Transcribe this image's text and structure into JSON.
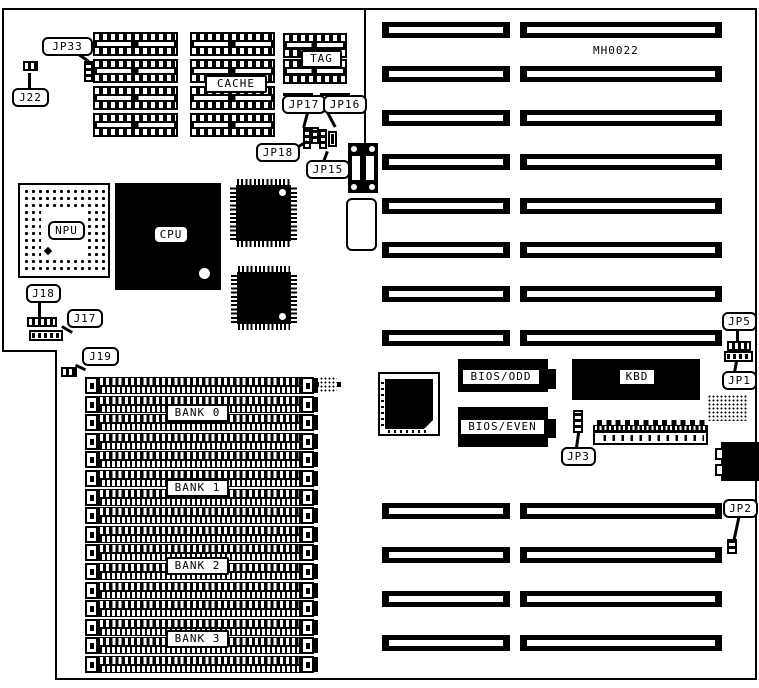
{
  "diagram": {
    "part_number": "MH0022",
    "callouts": {
      "jp33": "JP33",
      "j22": "J22",
      "jp17": "JP17",
      "jp16": "JP16",
      "jp18": "JP18",
      "jp15": "JP15",
      "j18": "J18",
      "j17": "J17",
      "j19": "J19",
      "jp5": "JP5",
      "jp1": "JP1",
      "jp2": "JP2",
      "jp3": "JP3"
    },
    "chips": {
      "cache": "CACHE",
      "tag": "TAG",
      "npu": "NPU",
      "cpu": "CPU",
      "bios_odd": "BIOS/ODD",
      "bios_even": "BIOS/EVEN",
      "kbd": "KBD"
    },
    "banks": [
      {
        "label": "BANK 0"
      },
      {
        "label": "BANK 1"
      },
      {
        "label": "BANK 2"
      },
      {
        "label": "BANK 3"
      }
    ],
    "colors": {
      "ink": "#000000",
      "paper": "#ffffff"
    }
  }
}
